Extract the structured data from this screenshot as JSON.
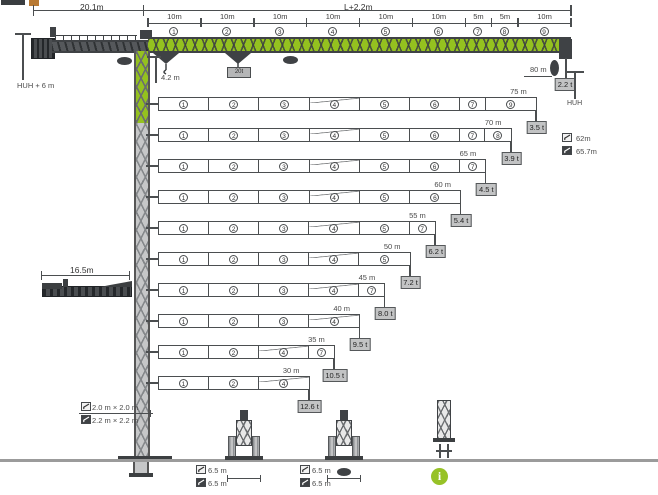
{
  "colors": {
    "accent_green": "#94c11f",
    "steel_dark": "#3f4245",
    "box_fill": "#c2c3c4",
    "info_green": "#97c227"
  },
  "header": {
    "counterjib_length": "20.1m",
    "jib_length_formula": "L+2.2m",
    "hook_height_label": "HUH + 6 m",
    "trolley_clearance": "4.2 m",
    "hook_block_capacity": "20t"
  },
  "jib": {
    "segments": [
      {
        "dim": "10m",
        "num": "1",
        "meters": 10
      },
      {
        "dim": "10m",
        "num": "2",
        "meters": 10
      },
      {
        "dim": "10m",
        "num": "3",
        "meters": 10
      },
      {
        "dim": "10m",
        "num": "4",
        "meters": 10
      },
      {
        "dim": "10m",
        "num": "5",
        "meters": 10
      },
      {
        "dim": "10m",
        "num": "6",
        "meters": 10
      },
      {
        "dim": "5m",
        "num": "7",
        "meters": 5
      },
      {
        "dim": "5m",
        "num": "8",
        "meters": 5
      },
      {
        "dim": "10m",
        "num": "9",
        "meters": 10
      }
    ]
  },
  "tip": {
    "max_radius": "80 m",
    "tip_capacity": "2.2 t",
    "hook_height_abbr": "HUH"
  },
  "legend": {
    "items": [
      {
        "variant": "light",
        "label": "62m"
      },
      {
        "variant": "dark",
        "label": "65.7m"
      }
    ]
  },
  "rows": [
    {
      "length_label": "75 m",
      "capacity_label": "3.5 t",
      "meters": 75,
      "segments": [
        {
          "num": "1",
          "m": 10
        },
        {
          "num": "2",
          "m": 10
        },
        {
          "num": "3",
          "m": 10
        },
        {
          "num": "4",
          "m": 10
        },
        {
          "num": "5",
          "m": 10
        },
        {
          "num": "6",
          "m": 10
        },
        {
          "num": "7",
          "m": 5
        },
        {
          "num": "9",
          "m": 10
        }
      ]
    },
    {
      "length_label": "70 m",
      "capacity_label": "3.9 t",
      "meters": 70,
      "segments": [
        {
          "num": "1",
          "m": 10
        },
        {
          "num": "2",
          "m": 10
        },
        {
          "num": "3",
          "m": 10
        },
        {
          "num": "4",
          "m": 10
        },
        {
          "num": "5",
          "m": 10
        },
        {
          "num": "6",
          "m": 10
        },
        {
          "num": "7",
          "m": 5
        },
        {
          "num": "8",
          "m": 5
        }
      ]
    },
    {
      "length_label": "65 m",
      "capacity_label": "4.5 t",
      "meters": 65,
      "segments": [
        {
          "num": "1",
          "m": 10
        },
        {
          "num": "2",
          "m": 10
        },
        {
          "num": "3",
          "m": 10
        },
        {
          "num": "4",
          "m": 10
        },
        {
          "num": "5",
          "m": 10
        },
        {
          "num": "6",
          "m": 10
        },
        {
          "num": "7",
          "m": 5
        }
      ]
    },
    {
      "length_label": "60 m",
      "capacity_label": "5.4 t",
      "meters": 60,
      "segments": [
        {
          "num": "1",
          "m": 10
        },
        {
          "num": "2",
          "m": 10
        },
        {
          "num": "3",
          "m": 10
        },
        {
          "num": "4",
          "m": 10
        },
        {
          "num": "5",
          "m": 10
        },
        {
          "num": "6",
          "m": 10
        }
      ]
    },
    {
      "length_label": "55 m",
      "capacity_label": "6.2 t",
      "meters": 55,
      "segments": [
        {
          "num": "1",
          "m": 10
        },
        {
          "num": "2",
          "m": 10
        },
        {
          "num": "3",
          "m": 10
        },
        {
          "num": "4",
          "m": 10
        },
        {
          "num": "5",
          "m": 10
        },
        {
          "num": "7",
          "m": 5
        }
      ]
    },
    {
      "length_label": "50 m",
      "capacity_label": "7.2 t",
      "meters": 50,
      "segments": [
        {
          "num": "1",
          "m": 10
        },
        {
          "num": "2",
          "m": 10
        },
        {
          "num": "3",
          "m": 10
        },
        {
          "num": "4",
          "m": 10
        },
        {
          "num": "5",
          "m": 10
        }
      ]
    },
    {
      "length_label": "45 m",
      "capacity_label": "8.0 t",
      "meters": 45,
      "segments": [
        {
          "num": "1",
          "m": 10
        },
        {
          "num": "2",
          "m": 10
        },
        {
          "num": "3",
          "m": 10
        },
        {
          "num": "4",
          "m": 10
        },
        {
          "num": "7",
          "m": 5
        }
      ]
    },
    {
      "length_label": "40 m",
      "capacity_label": "9.5 t",
      "meters": 40,
      "segments": [
        {
          "num": "1",
          "m": 10
        },
        {
          "num": "2",
          "m": 10
        },
        {
          "num": "3",
          "m": 10
        },
        {
          "num": "4",
          "m": 10
        }
      ]
    },
    {
      "length_label": "35 m",
      "capacity_label": "10.5 t",
      "meters": 35,
      "segments": [
        {
          "num": "1",
          "m": 10
        },
        {
          "num": "2",
          "m": 10
        },
        {
          "num": "4",
          "m": 10
        },
        {
          "num": "7",
          "m": 5
        }
      ]
    },
    {
      "length_label": "30 m",
      "capacity_label": "12.6 t",
      "meters": 30,
      "segments": [
        {
          "num": "1",
          "m": 10
        },
        {
          "num": "2",
          "m": 10
        },
        {
          "num": "4",
          "m": 10
        }
      ]
    }
  ],
  "erection": {
    "folded_length": "16.5m"
  },
  "mast": {
    "sections": [
      {
        "variant": "light",
        "label": "2.0 m × 2.0 m"
      },
      {
        "variant": "dark",
        "label": "2.2 m × 2.2 m"
      }
    ]
  },
  "foundations": [
    {
      "labels": [
        {
          "variant": "light",
          "label": "6.5 m"
        },
        {
          "variant": "dark",
          "label": "6.5 m"
        }
      ]
    },
    {
      "labels": [
        {
          "variant": "light",
          "label": "6.5 m"
        },
        {
          "variant": "dark",
          "label": "6.5 m"
        }
      ]
    }
  ],
  "info": {
    "label": "i"
  }
}
